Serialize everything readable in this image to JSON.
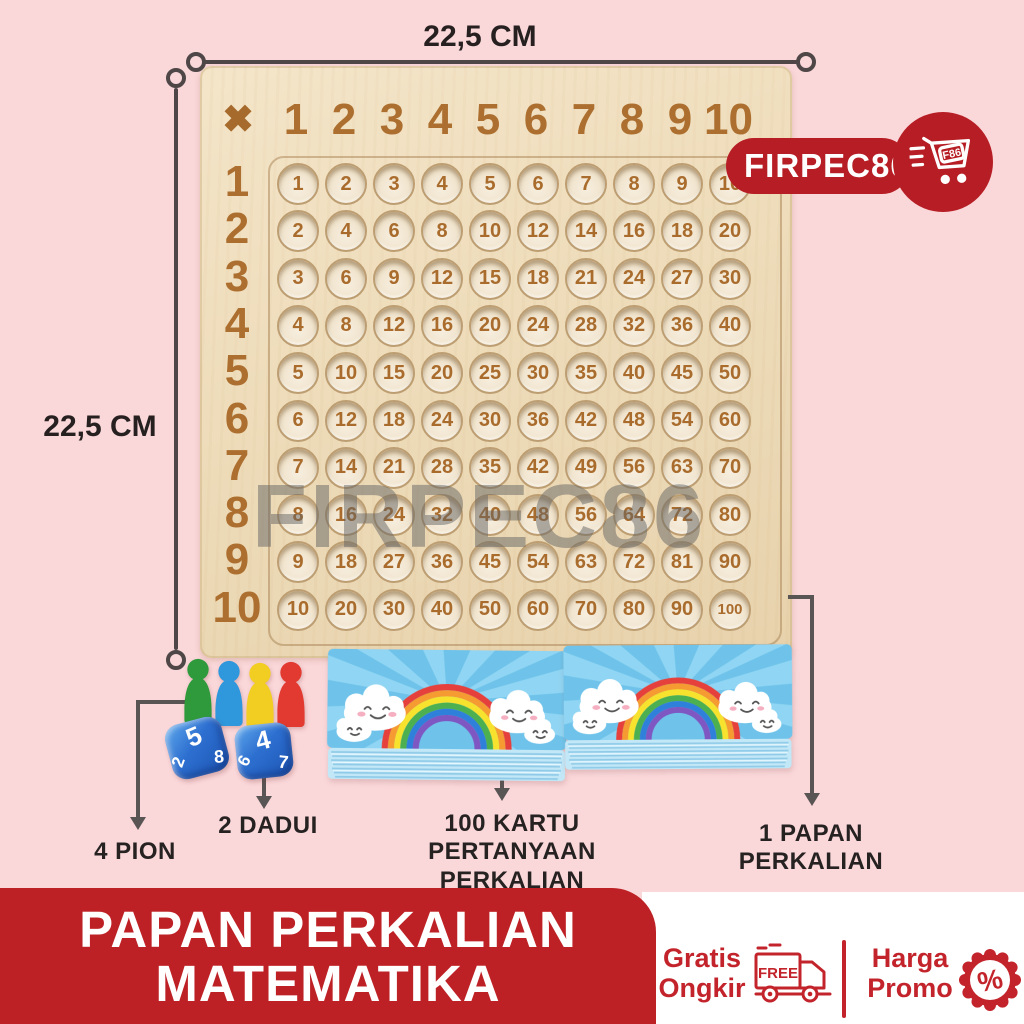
{
  "dimensions": {
    "top": "22,5 CM",
    "left": "22,5 CM"
  },
  "store_badge": {
    "name": "FIRPEC86",
    "cart_tag": "F86"
  },
  "watermark": "FIRPEC86",
  "board": {
    "multiply_symbol": "✖",
    "header": [
      "1",
      "2",
      "3",
      "4",
      "5",
      "6",
      "7",
      "8",
      "9",
      "10"
    ],
    "row_headers": [
      "1",
      "2",
      "3",
      "4",
      "5",
      "6",
      "7",
      "8",
      "9",
      "10"
    ],
    "cells": [
      [
        1,
        2,
        3,
        4,
        5,
        6,
        7,
        8,
        9,
        10
      ],
      [
        2,
        4,
        6,
        8,
        10,
        12,
        14,
        16,
        18,
        20
      ],
      [
        3,
        6,
        9,
        12,
        15,
        18,
        21,
        24,
        27,
        30
      ],
      [
        4,
        8,
        12,
        16,
        20,
        24,
        28,
        32,
        36,
        40
      ],
      [
        5,
        10,
        15,
        20,
        25,
        30,
        35,
        40,
        45,
        50
      ],
      [
        6,
        12,
        18,
        24,
        30,
        36,
        42,
        48,
        54,
        60
      ],
      [
        7,
        14,
        21,
        28,
        35,
        42,
        49,
        56,
        63,
        70
      ],
      [
        8,
        16,
        24,
        32,
        40,
        48,
        56,
        64,
        72,
        80
      ],
      [
        9,
        18,
        27,
        36,
        45,
        54,
        63,
        72,
        81,
        90
      ],
      [
        10,
        20,
        30,
        40,
        50,
        60,
        70,
        80,
        90,
        100
      ]
    ]
  },
  "components": {
    "pions": {
      "label": "4 PION",
      "colors": [
        "#2E9A3C",
        "#2F97DC",
        "#F2CD22",
        "#E23A30"
      ]
    },
    "dice": {
      "label": "2 DADUI",
      "color": "#2F79D8",
      "faces": [
        [
          "5",
          "2",
          "8"
        ],
        [
          "4",
          "6",
          "7"
        ]
      ]
    },
    "cards": {
      "label_line1": "100 KARTU PERTANYAAN",
      "label_line2": "PERKALIAN"
    },
    "board_label": {
      "label_line1": "1 PAPAN",
      "label_line2": "PERKALIAN"
    }
  },
  "banner": {
    "line1": "PAPAN PERKALIAN",
    "line2": "MATEMATIKA"
  },
  "footer": {
    "shipping": {
      "line1": "Gratis",
      "line2": "Ongkir",
      "truck_text": "FREE"
    },
    "promo": {
      "line1": "Harga",
      "line2": "Promo",
      "badge_symbol": "%"
    }
  },
  "colors": {
    "background": "#FAD7D9",
    "banner_red": "#BE2125",
    "badge_red": "#B71D24",
    "footer_red": "#C3242B",
    "engraving_brown": "#AC6F2F",
    "wood_light": "#F2E2C4",
    "card_blue": "#6FC3EA",
    "line_gray": "#4F4747"
  }
}
